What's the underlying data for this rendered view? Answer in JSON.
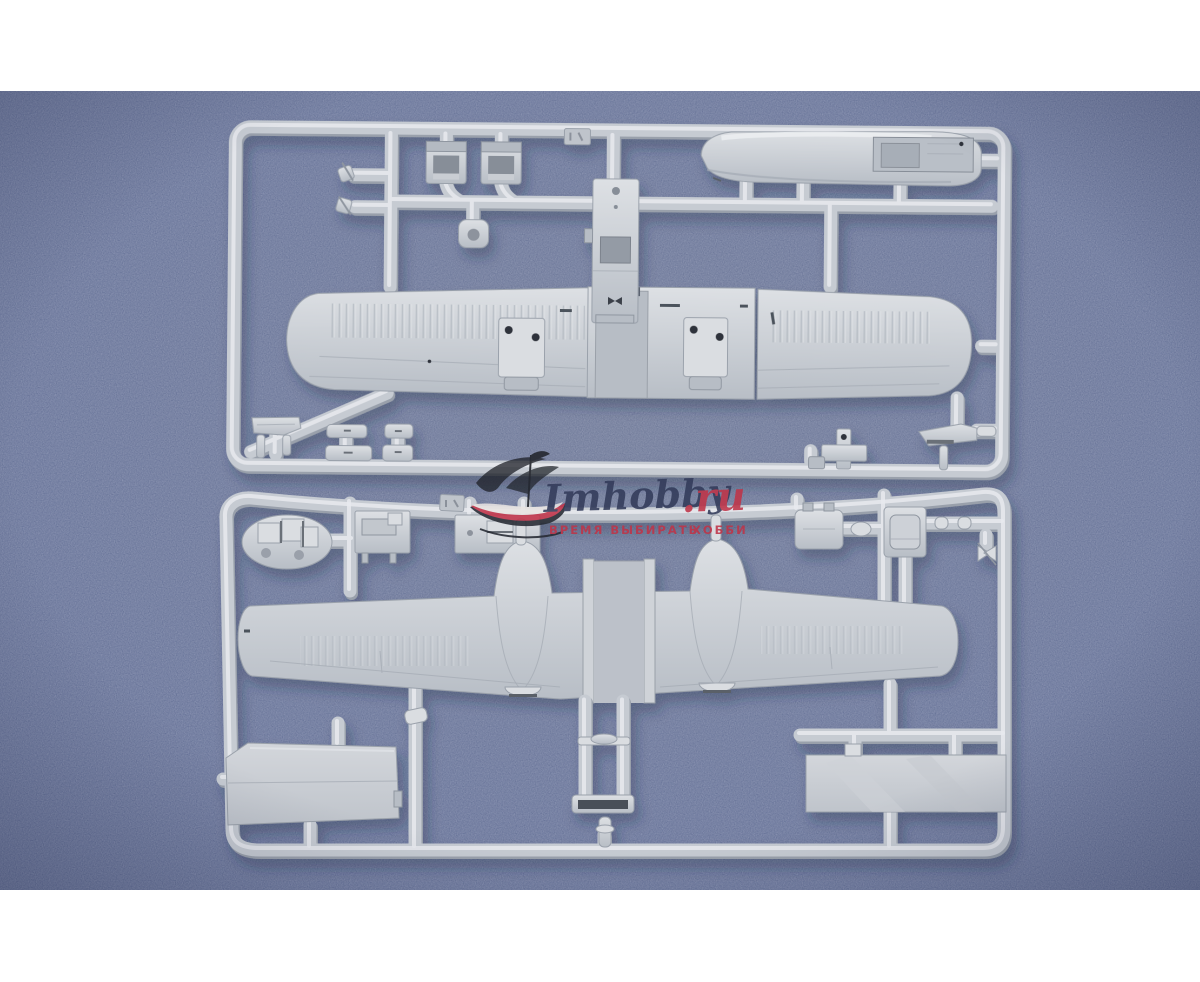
{
  "meta": {
    "type": "product-photo",
    "subject": "Two light-grey injection-moulded plastic sprues (runners) of an aircraft scale-model kit photographed on a mottled blue background with shop watermark"
  },
  "photo": {
    "letterbox_color": "#ffffff",
    "background_color": "#6b78a0",
    "plastic_color": "#c6cbd2",
    "shadow_color": "#1c2547"
  },
  "watermark": {
    "brand": "Imhobby",
    "tld": ".ru",
    "slogan_left": "ВРЕМЯ ВЫБИРАТЬ",
    "slogan_right": "ХОББИ",
    "brand_color": "#333b5a",
    "accent_color": "#bf3448",
    "logo": "sailing-ship"
  },
  "scene": {
    "sprues": [
      {
        "name": "upper sprue",
        "parts": [
          "fuselage nose pod half with cockpit opening",
          "two pilot seats",
          "cockpit floor frame",
          "upper wing half left (corrugated)",
          "upper wing half right (corrugated)",
          "wing centre section with channel",
          "two radiator blocks with locating holes",
          "small control levers",
          "flat fairing strips",
          "mounting bracket",
          "intake scoop",
          "sprue letter tab"
        ]
      },
      {
        "name": "lower sprue",
        "parts": [
          "engine block",
          "detail plate",
          "cockpit floor plate",
          "full-span lower wing with twin engine nacelles",
          "fuselage keel frame with cross-bar",
          "large trapezoid hatch panel",
          "large rectangular panel",
          "gearbox housings",
          "connector cylinders",
          "small butterfly linkage",
          "tail pin",
          "sprue letter tab"
        ]
      }
    ]
  }
}
